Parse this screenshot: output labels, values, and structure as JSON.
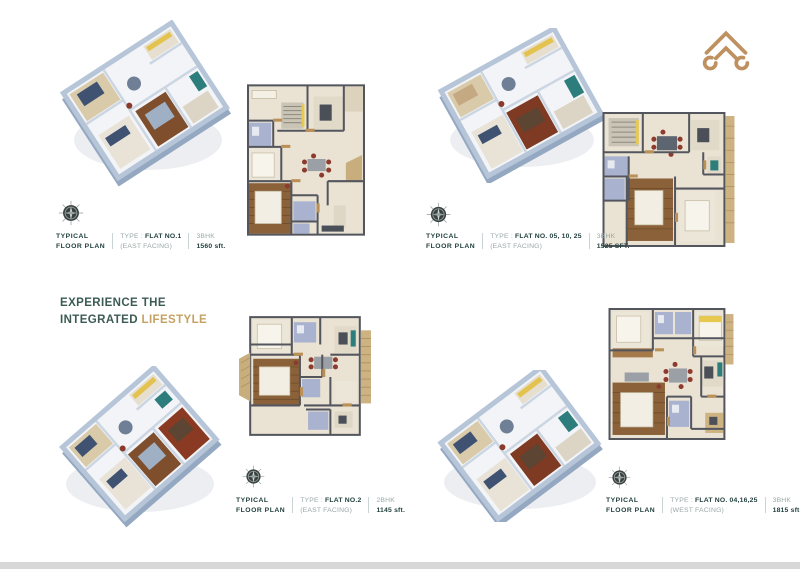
{
  "heading": {
    "line1": "EXPERIENCE THE",
    "line2_dark": "INTEGRATED",
    "line2_gold": "LIFESTYLE"
  },
  "icons": {
    "logo": "roof-emblem-icon",
    "compass": "compass-rose-icon"
  },
  "colors": {
    "heading_teal": "#3c5b55",
    "accent_gold": "#c5a262",
    "caption_dark": "#21403d",
    "caption_light": "#9aa7a7",
    "logo_gold": "#bf9060",
    "bottom_bar": "#d8d8d8",
    "plan_floor": "#eae3d4",
    "plan_wall": "#54565e",
    "plan_wood": "#8a6138",
    "plan_bath": "#a9b2ce",
    "plan_balcony": "#c9ae7d"
  },
  "plans": [
    {
      "title_line1": "TYPICAL",
      "title_line2": "FLOOR PLAN",
      "type_prefix": "TYPE : ",
      "flat": "FLAT NO.1",
      "facing": "(EAST FACING)",
      "bhk": "3BHK",
      "area": "1560 sft."
    },
    {
      "title_line1": "TYPICAL",
      "title_line2": "FLOOR PLAN",
      "type_prefix": "TYPE : ",
      "flat": "FLAT NO. 05, 10, 25",
      "facing": "(EAST FACING)",
      "bhk": "3BHK",
      "area": "1525 SFT."
    },
    {
      "title_line1": "TYPICAL",
      "title_line2": "FLOOR PLAN",
      "type_prefix": "TYPE : ",
      "flat": "FLAT NO.2",
      "facing": "(EAST FACING)",
      "bhk": "2BHK",
      "area": "1145 sft."
    },
    {
      "title_line1": "TYPICAL",
      "title_line2": "FLOOR PLAN",
      "type_prefix": "TYPE : ",
      "flat": "FLAT NO. 04,16,25",
      "facing": "(WEST FACING)",
      "bhk": "3BHK",
      "area": "1815 sft."
    }
  ]
}
